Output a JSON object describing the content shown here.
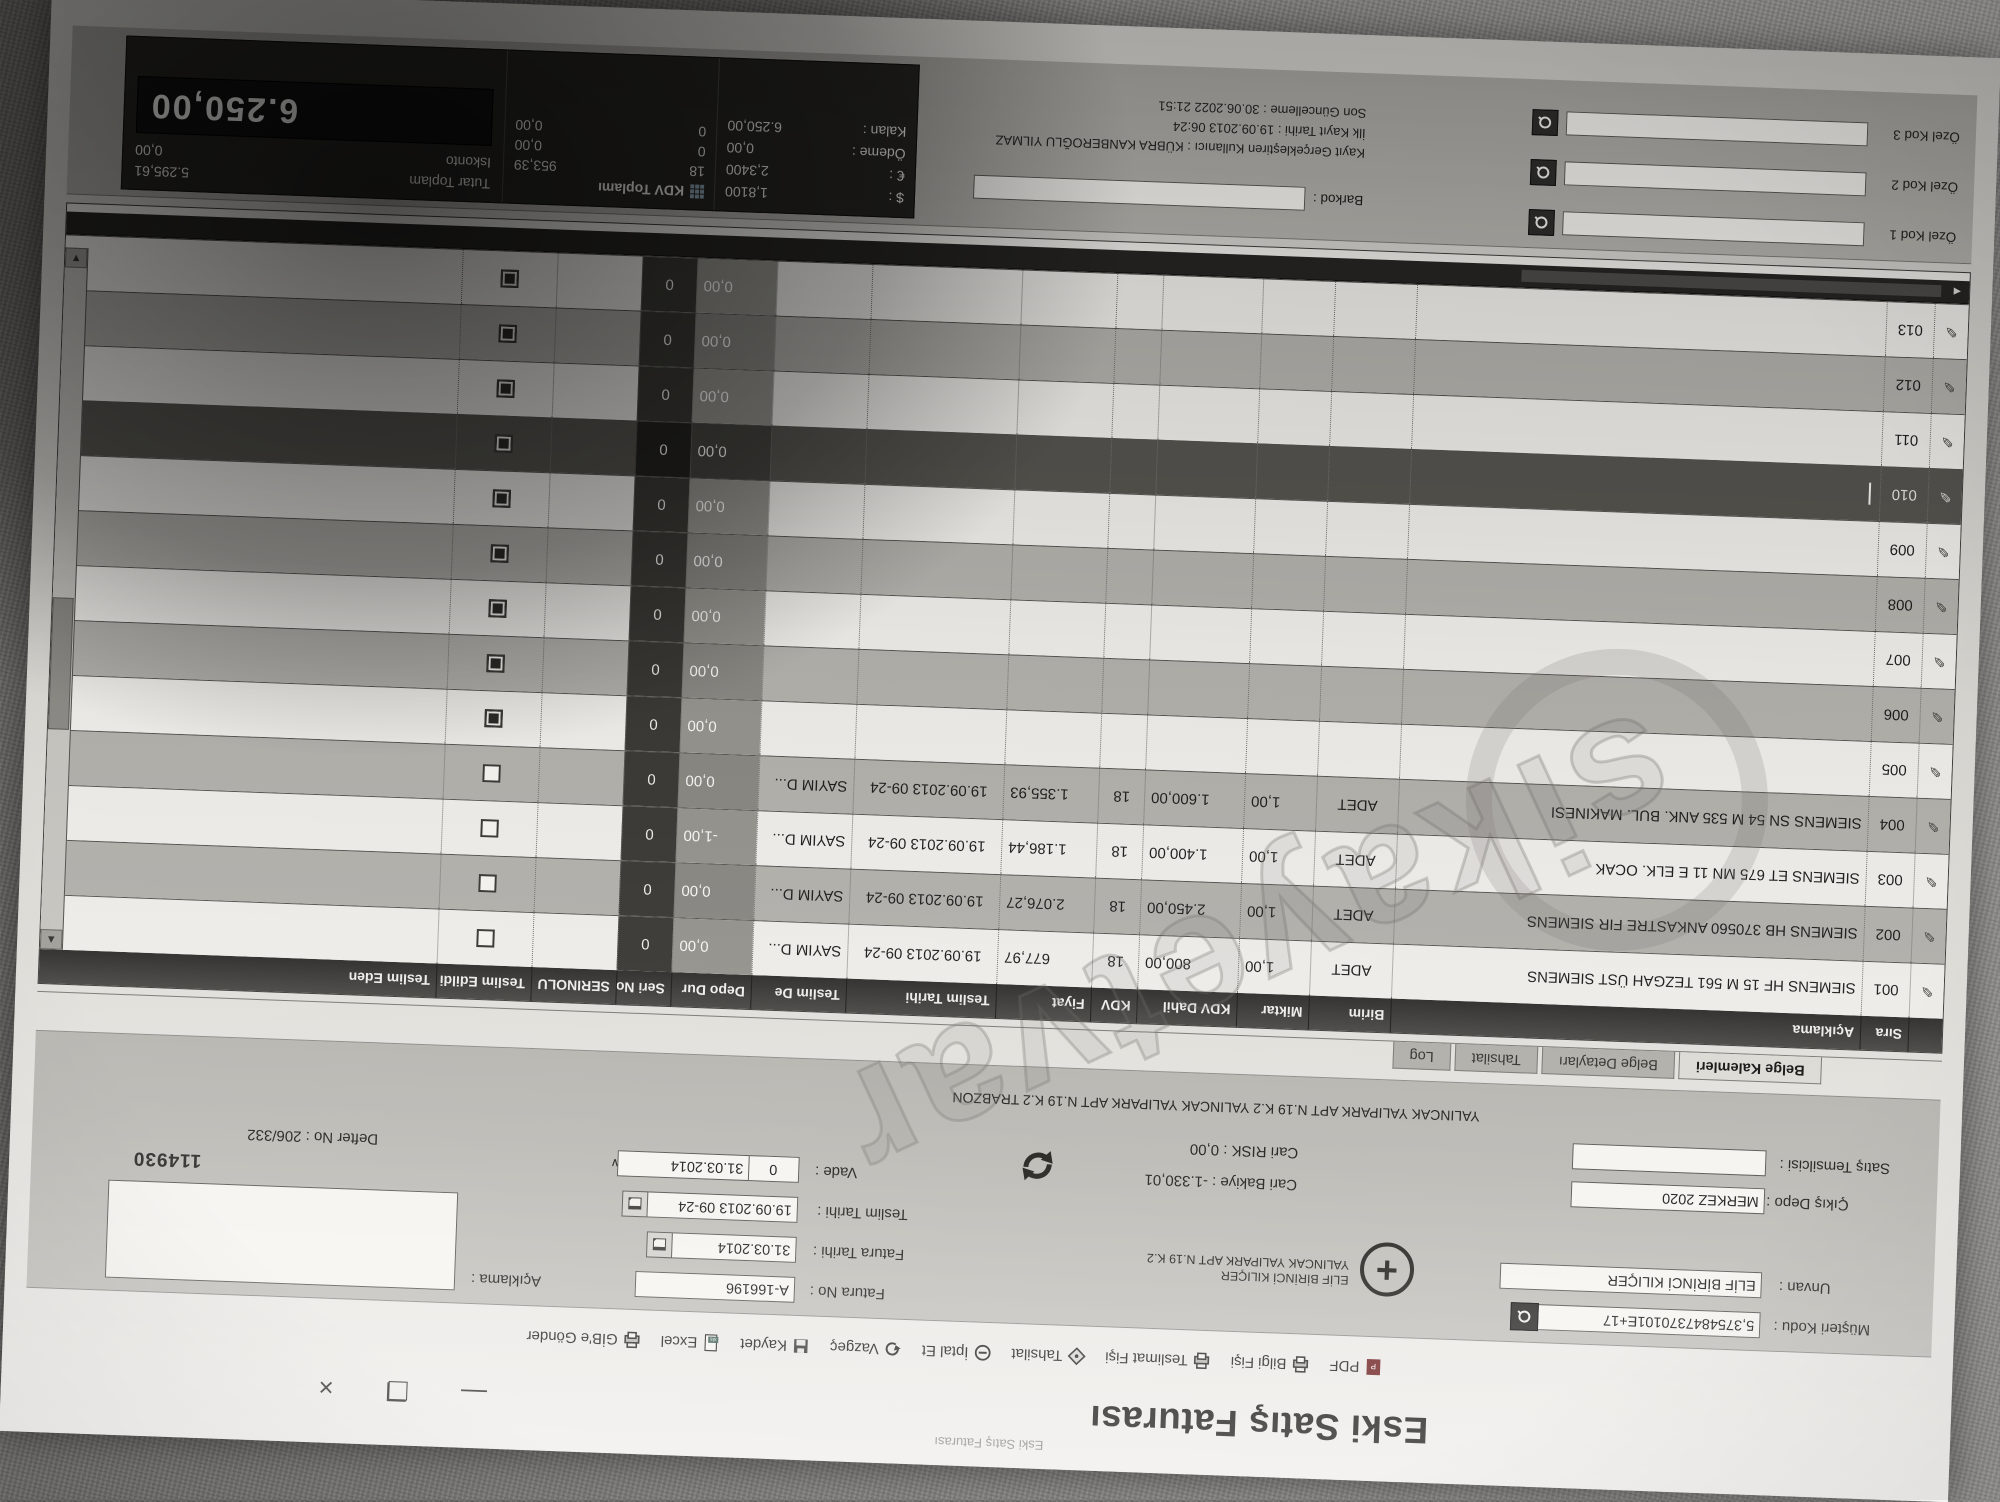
{
  "watermark": {
    "text": "sikayetvar"
  },
  "window": {
    "caption": "Eski Satış Faturası",
    "title": "Eski Satış Faturası",
    "minimize": "—",
    "restore": "❐",
    "close": "×"
  },
  "toolbar": {
    "items": [
      {
        "label": "PDF"
      },
      {
        "label": "Bilgi Fişi"
      },
      {
        "label": "Teslimat Fişi"
      },
      {
        "label": "Tahsilat"
      },
      {
        "label": "İptal Et"
      },
      {
        "label": "Vazgeç"
      },
      {
        "label": "Kaydet"
      },
      {
        "label": "Excel"
      },
      {
        "label": "GİB'e Gönder"
      }
    ]
  },
  "form": {
    "musteri_kodu_label": "Müşteri Kodu :",
    "musteri_kodu": "5,3754847370101E+17",
    "unvan_label": "Unvan :",
    "unvan": "ELİF BİRİNCİ KILIÇER",
    "address_line1": "ELİF BİRİNCİ KILIÇER",
    "address_line2": "YALINCAK YALIPARK APT N.19 K.2",
    "address_full": "YALINCAK YALIPARK APT N.19 K.2 YALINCAK YALIPARK APT N.19 K.2 TRABZON",
    "cikis_depo_label": "Çıkış Depo :",
    "cikis_depo": "MERKEZ 2020",
    "satis_temsilcisi_label": "Satış Temsilcisi :",
    "satis_temsilcisi": "",
    "cari_bakiye_label": "Cari Bakiye :",
    "cari_bakiye": "-1.330,01",
    "cari_risk_label": "Cari RISK :",
    "cari_risk": "0,00",
    "fatura_no_label": "Fatura No :",
    "fatura_no": "A-166196",
    "fatura_tarihi_label": "Fatura Tarihi :",
    "fatura_tarihi": "31.03.2014",
    "teslim_tarihi_label": "Teslim Tarihi :",
    "teslim_tarihi": "19.09.2013 09-24",
    "vade_label": "Vade :",
    "vade_gun": "0",
    "vade_tarihi": "31.03.2014",
    "aciklama_label": "Açıklama :",
    "defter_no": "Defter No : 206/332",
    "belge_no": "114930"
  },
  "tabs": {
    "items": [
      "Belge Kalemleri",
      "Belge Detayları",
      "Tahsilat",
      "Log"
    ],
    "active": "Belge Kalemleri"
  },
  "grid": {
    "columns": [
      "Sıra",
      "Açıklama",
      "Birim",
      "Miktar",
      "KDV Dahil",
      "KDV",
      "Fiyat",
      "Teslim Tarihi",
      "Teslim De",
      "Depo Dur",
      "Seri No",
      "SERINOLU",
      "Teslim Edildi",
      "Teslim Eden"
    ],
    "rows": [
      {
        "sira": "001",
        "aciklama": "SIEMENS HF 15 M 561 TEZGAH ÜST SIEMENS",
        "birim": "ADET",
        "miktar": "1,00",
        "kdv_dahil": "800,00",
        "kdv": "18",
        "fiyat": "677,97",
        "teslim_tarihi": "19.09.2013 09-24",
        "teslim_depo": "SAYIM D...",
        "depo_dur": "0,00",
        "seri_no": "0",
        "serinolu": "",
        "teslim_edildi": false,
        "teslim_eden": "",
        "selected": false
      },
      {
        "sira": "002",
        "aciklama": "SIEMENS HB 370560 ANKASTRE FIR SIEMENS",
        "birim": "ADET",
        "miktar": "1,00",
        "kdv_dahil": "2.450,00",
        "kdv": "18",
        "fiyat": "2.076,27",
        "teslim_tarihi": "19.09.2013 09-24",
        "teslim_depo": "SAYIM D...",
        "depo_dur": "0,00",
        "seri_no": "0",
        "serinolu": "",
        "teslim_edildi": false,
        "teslim_eden": "",
        "selected": false
      },
      {
        "sira": "003",
        "aciklama": "SIEMENS ET 675 MN 11 E ELK. OCAK",
        "birim": "ADET",
        "miktar": "1,00",
        "kdv_dahil": "1.400,00",
        "kdv": "18",
        "fiyat": "1.186,44",
        "teslim_tarihi": "19.09.2013 09-24",
        "teslim_depo": "SAYIM D...",
        "depo_dur": "-1,00",
        "seri_no": "0",
        "serinolu": "",
        "teslim_edildi": false,
        "teslim_eden": "",
        "selected": false
      },
      {
        "sira": "004",
        "aciklama": "SIEMENS SN 54 M 535 ANK. BUL. MAKINESI",
        "birim": "ADET",
        "miktar": "1,00",
        "kdv_dahil": "1.600,00",
        "kdv": "18",
        "fiyat": "1.355,93",
        "teslim_tarihi": "19.09.2013 09-24",
        "teslim_depo": "SAYIM D...",
        "depo_dur": "0,00",
        "seri_no": "0",
        "serinolu": "",
        "teslim_edildi": false,
        "teslim_eden": "",
        "selected": false
      },
      {
        "sira": "005",
        "aciklama": "",
        "birim": "",
        "miktar": "",
        "kdv_dahil": "",
        "kdv": "",
        "fiyat": "",
        "teslim_tarihi": "",
        "teslim_depo": "",
        "depo_dur": "0,00",
        "seri_no": "0",
        "serinolu": "",
        "teslim_edildi": true,
        "teslim_eden": "",
        "selected": false
      },
      {
        "sira": "006",
        "aciklama": "",
        "birim": "",
        "miktar": "",
        "kdv_dahil": "",
        "kdv": "",
        "fiyat": "",
        "teslim_tarihi": "",
        "teslim_depo": "",
        "depo_dur": "0,00",
        "seri_no": "0",
        "serinolu": "",
        "teslim_edildi": true,
        "teslim_eden": "",
        "selected": false
      },
      {
        "sira": "007",
        "aciklama": "",
        "birim": "",
        "miktar": "",
        "kdv_dahil": "",
        "kdv": "",
        "fiyat": "",
        "teslim_tarihi": "",
        "teslim_depo": "",
        "depo_dur": "0,00",
        "seri_no": "0",
        "serinolu": "",
        "teslim_edildi": true,
        "teslim_eden": "",
        "selected": false
      },
      {
        "sira": "008",
        "aciklama": "",
        "birim": "",
        "miktar": "",
        "kdv_dahil": "",
        "kdv": "",
        "fiyat": "",
        "teslim_tarihi": "",
        "teslim_depo": "",
        "depo_dur": "0,00",
        "seri_no": "0",
        "serinolu": "",
        "teslim_edildi": true,
        "teslim_eden": "",
        "selected": false
      },
      {
        "sira": "009",
        "aciklama": "",
        "birim": "",
        "miktar": "",
        "kdv_dahil": "",
        "kdv": "",
        "fiyat": "",
        "teslim_tarihi": "",
        "teslim_depo": "",
        "depo_dur": "0,00",
        "seri_no": "0",
        "serinolu": "",
        "teslim_edildi": true,
        "teslim_eden": "",
        "selected": false
      },
      {
        "sira": "010",
        "aciklama": "",
        "birim": "",
        "miktar": "",
        "kdv_dahil": "",
        "kdv": "",
        "fiyat": "",
        "teslim_tarihi": "",
        "teslim_depo": "",
        "depo_dur": "0,00",
        "seri_no": "0",
        "serinolu": "",
        "teslim_edildi": true,
        "teslim_eden": "",
        "selected": true
      },
      {
        "sira": "011",
        "aciklama": "",
        "birim": "",
        "miktar": "",
        "kdv_dahil": "",
        "kdv": "",
        "fiyat": "",
        "teslim_tarihi": "",
        "teslim_depo": "",
        "depo_dur": "0,00",
        "seri_no": "0",
        "serinolu": "",
        "teslim_edildi": true,
        "teslim_eden": "",
        "selected": false
      },
      {
        "sira": "012",
        "aciklama": "",
        "birim": "",
        "miktar": "",
        "kdv_dahil": "",
        "kdv": "",
        "fiyat": "",
        "teslim_tarihi": "",
        "teslim_depo": "",
        "depo_dur": "0,00",
        "seri_no": "0",
        "serinolu": "",
        "teslim_edildi": true,
        "teslim_eden": "",
        "selected": false
      },
      {
        "sira": "013",
        "aciklama": "",
        "birim": "",
        "miktar": "",
        "kdv_dahil": "",
        "kdv": "",
        "fiyat": "",
        "teslim_tarihi": "",
        "teslim_depo": "",
        "depo_dur": "0,00",
        "seri_no": "0",
        "serinolu": "",
        "teslim_edildi": true,
        "teslim_eden": "",
        "selected": false
      }
    ]
  },
  "footer": {
    "ozel_kod_1_label": "Özel Kod 1",
    "ozel_kod_2_label": "Özel Kod 2",
    "ozel_kod_3_label": "Özel Kod 3",
    "barkod_label": "Barkod :",
    "audit_user": "Kayıt Gerçekleştiren Kullanıcı : KÜBRA KANBEROĞLU YILMAZ",
    "audit_created": "İlk Kayıt Tarihi : 19.09.2013 06:24",
    "audit_updated": "Son Güncelleme : 30.06.2022 21:51",
    "kdv_box": {
      "title": "KDV Toplamı",
      "usd_label": "$ :",
      "usd_value": "1,8100",
      "eur_label": "€ :",
      "eur_value": "2,3400",
      "odeme_label": "Ödeme :",
      "odeme_value": "0,00",
      "kalan_label": "Kalan :",
      "kalan_value": "6.250,00",
      "rate_rows": [
        {
          "rate": "18",
          "amount": "953,39"
        },
        {
          "rate": "0",
          "amount": "0,00"
        },
        {
          "rate": "0",
          "amount": "0,00"
        }
      ]
    },
    "totals": {
      "tutar_label": "Tutar Toplam",
      "tutar_value": "5.295,61",
      "iskonto_label": "Iskonto",
      "iskonto_value": "0,00",
      "grand_total": "6.250,00"
    }
  }
}
